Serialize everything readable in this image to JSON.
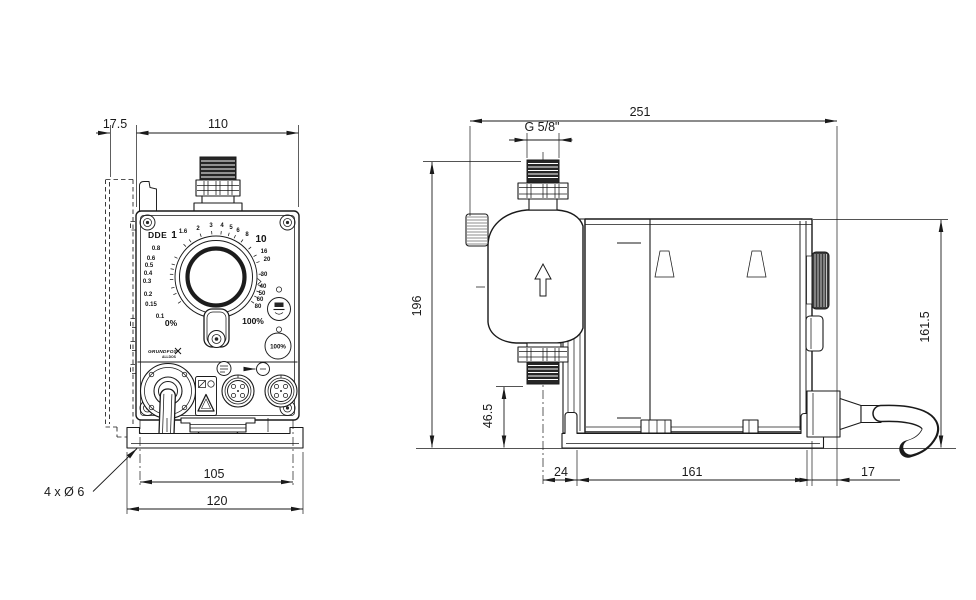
{
  "front": {
    "model": "DDE",
    "brand": "GRUNDFOS",
    "brand_sub": "ALLDOS",
    "button_100_label": "100%",
    "dial_scale": [
      {
        "t": "1",
        "x": 174,
        "y": 238,
        "s": 10
      },
      {
        "t": "1.6",
        "x": 183,
        "y": 233,
        "s": 6
      },
      {
        "t": "2",
        "x": 198,
        "y": 230,
        "s": 6
      },
      {
        "t": "3",
        "x": 211,
        "y": 227,
        "s": 6
      },
      {
        "t": "4",
        "x": 222,
        "y": 227,
        "s": 6
      },
      {
        "t": "5",
        "x": 231,
        "y": 229,
        "s": 6
      },
      {
        "t": "6",
        "x": 238,
        "y": 232,
        "s": 6
      },
      {
        "t": "8",
        "x": 247,
        "y": 236,
        "s": 6
      },
      {
        "t": "10",
        "x": 261,
        "y": 242,
        "s": 10
      },
      {
        "t": "16",
        "x": 264,
        "y": 253,
        "s": 6
      },
      {
        "t": "20",
        "x": 267,
        "y": 261,
        "s": 6
      },
      {
        "t": "30",
        "x": 264,
        "y": 276,
        "s": 6
      },
      {
        "t": "40",
        "x": 263,
        "y": 288,
        "s": 6
      },
      {
        "t": "50",
        "x": 262,
        "y": 295,
        "s": 6
      },
      {
        "t": "60",
        "x": 260,
        "y": 301,
        "s": 6
      },
      {
        "t": "80",
        "x": 258,
        "y": 308,
        "s": 6
      },
      {
        "t": "100%",
        "x": 253,
        "y": 324,
        "s": 8.5
      },
      {
        "t": "0%",
        "x": 171,
        "y": 326,
        "s": 8.5
      },
      {
        "t": "0.1",
        "x": 160,
        "y": 318,
        "s": 6
      },
      {
        "t": "0.15",
        "x": 151,
        "y": 306,
        "s": 6
      },
      {
        "t": "0.2",
        "x": 148,
        "y": 296,
        "s": 6
      },
      {
        "t": "0.3",
        "x": 147,
        "y": 283,
        "s": 6
      },
      {
        "t": "0.4",
        "x": 148,
        "y": 275,
        "s": 6
      },
      {
        "t": "0.5",
        "x": 149,
        "y": 267,
        "s": 6
      },
      {
        "t": "0.6",
        "x": 151,
        "y": 260,
        "s": 6
      },
      {
        "t": "0.8",
        "x": 156,
        "y": 250,
        "s": 6
      }
    ],
    "dims": {
      "bracket_depth": "17.5",
      "width": "110",
      "base_slot_span": "105",
      "base_width": "120",
      "mounting_holes": "4 x Ø 6"
    }
  },
  "side": {
    "dims": {
      "total_length": "251",
      "thread": "G 5/8\"",
      "total_height": "196",
      "outlet_height": "46.5",
      "housing_height": "161.5",
      "base_front_offset": "24",
      "base_length": "161",
      "cable_offset": "17"
    }
  }
}
